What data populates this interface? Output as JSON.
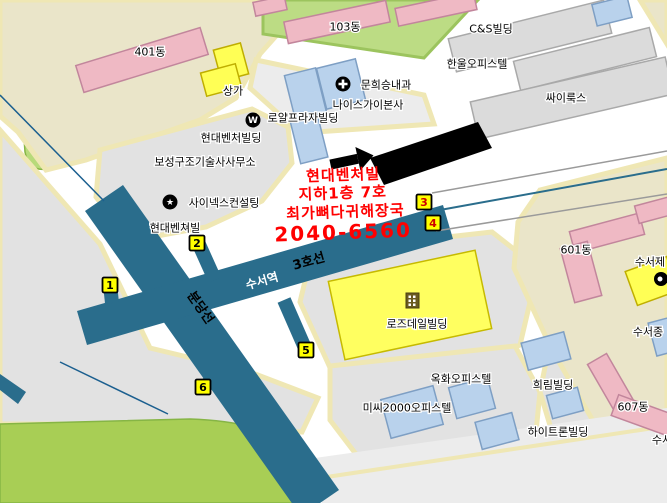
{
  "colors": {
    "subway_band": "#2a6d8c",
    "badge_yellow": "#ffff00",
    "badge_number_black": "#000000",
    "badge_number_red": "#cc0000",
    "ad_text_red": "#ff0000",
    "park_green": "#a8ce55",
    "block_beige": "#eae5c9",
    "building_pink": "#efb9c4",
    "building_blue": "#b9d2ec",
    "building_yellow": "#ffff55",
    "highlighted_building_black": "#000000"
  },
  "subway": {
    "line3_label": "3호선",
    "station_label": "수서역",
    "bundang_label": "분당선",
    "exits": [
      {
        "number": "1",
        "highlighted": false
      },
      {
        "number": "2",
        "highlighted": false
      },
      {
        "number": "3",
        "highlighted": true
      },
      {
        "number": "4",
        "highlighted": true
      },
      {
        "number": "5",
        "highlighted": false
      },
      {
        "number": "6",
        "highlighted": false
      }
    ]
  },
  "ad": {
    "building": "현대벤처빌",
    "floor": "지하1층 7호",
    "shop": "최가뼈다귀해장국",
    "phone": "2040-6560"
  },
  "labels": {
    "apt_401": "401동",
    "sangga": "상가",
    "apt_103": "103동",
    "cs_building": "C&S빌딩",
    "hanul_officetel": "한울오피스텔",
    "cyrux": "싸이룩스",
    "clinic": "문희승내과",
    "niceguy": "나이스가이본사",
    "royal_plaza": "로얄프라자빌딩",
    "hyundai_venture_building": "현대벤처빌딩",
    "boseong_office": "보성구조기술사사무소",
    "synex_consulting": "사이넥스컨설팅",
    "hyundai_venture_bldg2": "현대벤쳐빌",
    "rosedale_building": "로즈데일빌딩",
    "apt_601": "601동",
    "suseo_je": "수서제",
    "suseo_jong": "수서종",
    "okhwa_officetel": "옥화오피스텔",
    "missy2000_officetel": "미씨2000오피스텔",
    "heerim_building": "희림빌딩",
    "hitron_building": "하이트론빌딩",
    "apt_607": "607동",
    "suseo_partial": "수서"
  },
  "icons": {
    "metro_w": "W",
    "star": "★"
  }
}
